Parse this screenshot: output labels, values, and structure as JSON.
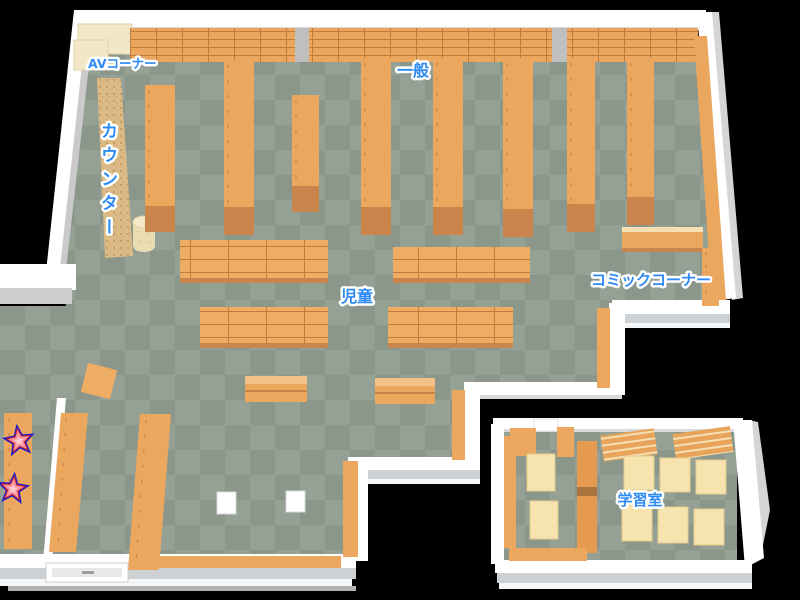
{
  "map": {
    "type": "library-floor-map",
    "labels": {
      "av_corner": "AVコーナー",
      "general": "一般",
      "counter": "カウンター",
      "children": "児童",
      "comic_corner": "コミックコーナー",
      "study_room": "学習室"
    },
    "markers": [
      {
        "icon": "star-icon"
      },
      {
        "icon": "star-icon"
      }
    ],
    "colors": {
      "background": "#000000",
      "floor_light": "#96A196",
      "floor_dark": "#8C978C",
      "wall": "#FFFFFF",
      "wall_shade": "#CDD1D4",
      "shelf": "#ECA75F",
      "shelf_line": "#C07B3F",
      "shelf_end": "#C9854B",
      "av_shelf": "#F2E8C8",
      "counter": "#DCBA85",
      "table": "#F7E3AE",
      "pillar": "#BFBFBF",
      "label_fill": "#2E8BF5",
      "label_outline": "#FFFFFF",
      "star_fill": "#F7949F",
      "star_ring": "#D82525",
      "star_outline": "#1A1ACC"
    }
  }
}
